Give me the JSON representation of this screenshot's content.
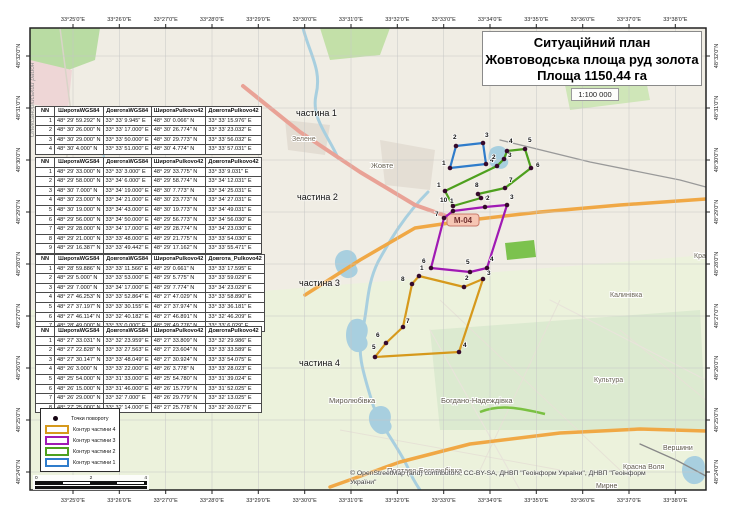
{
  "title_box": {
    "line1": "Ситуаційний план",
    "line2": "Жовтоводська площа руд золота",
    "line3": "Площа 1150,44 га"
  },
  "scale_label": "1:100 000",
  "attribution": {
    "line1": "© OpenStreetMap (and) contributors, CC-BY-SA, ДНВП \"Геоінформ України\", ДНВП \"Геоінформ",
    "line2": "України\""
  },
  "scalebar": {
    "ticks": [
      "0",
      "2",
      "4"
    ]
  },
  "legend": {
    "items": [
      {
        "type": "point",
        "label": "Точки повороту",
        "color": "#160412"
      },
      {
        "type": "outline",
        "label": "Контур частини 4",
        "color": "#d6991c"
      },
      {
        "type": "outline",
        "label": "Контур частини 3",
        "color": "#a01ab4"
      },
      {
        "type": "outline",
        "label": "Контур частини 2",
        "color": "#4ea01e"
      },
      {
        "type": "outline",
        "label": "Контур частини 1",
        "color": "#2f7ccb"
      }
    ]
  },
  "axes": {
    "lon_labels": [
      "33°25'0\"E",
      "33°26'0\"E",
      "33°27'0\"E",
      "33°28'0\"E",
      "33°29'0\"E",
      "33°30'0\"E",
      "33°31'0\"E",
      "33°32'0\"E",
      "33°33'0\"E",
      "33°34'0\"E",
      "33°35'0\"E",
      "33°36'0\"E",
      "33°37'0\"E",
      "33°38'0\"E"
    ],
    "lon_ticks_x": [
      73,
      119.3,
      165.7,
      212,
      258.3,
      304.7,
      351,
      397.3,
      443.7,
      490,
      536.3,
      582.7,
      629,
      675.3
    ],
    "lat_labels": [
      "48°32'0\"N",
      "48°31'0\"N",
      "48°30'0\"N",
      "48°29'0\"N",
      "48°28'0\"N",
      "48°27'0\"N",
      "48°26'0\"N",
      "48°25'0\"N",
      "48°24'0\"N"
    ],
    "lat_ticks_y": [
      56,
      108,
      160,
      212,
      264,
      316,
      368,
      420,
      472
    ]
  },
  "tables": [
    {
      "caption": "частина 1",
      "caption_pos": [
        296,
        108
      ],
      "pos_class": "t1",
      "headers": [
        "NN",
        "ШиротаWGS84",
        "ДовготаWGS84",
        "ШиротаPulkovo42",
        "ДовготаPulkovo42"
      ],
      "rows": [
        [
          "1",
          "48° 29' 59.292\" N",
          "33° 33' 9.945\" E",
          "48° 30' 0.066\" N",
          "33° 33' 15.976\" E"
        ],
        [
          "2",
          "48° 30' 26.000\" N",
          "33° 33' 17.000\" E",
          "48° 30' 26.774\" N",
          "33° 33' 23.032\" E"
        ],
        [
          "3",
          "48° 30' 29.000\" N",
          "33° 33' 50.000\" E",
          "48° 30' 29.773\" N",
          "33° 33' 56.032\" E"
        ],
        [
          "4",
          "48° 30' 4.000\" N",
          "33° 33' 51.000\" E",
          "48° 30' 4.774\" N",
          "33° 33' 57.031\" E"
        ]
      ]
    },
    {
      "caption": "частина 2",
      "caption_pos": [
        297,
        192
      ],
      "pos_class": "t2",
      "headers": [
        "NN",
        "ШиротаWGS84",
        "ДовготаWGS84",
        "ШиротаPulkovo42",
        "ДовготаPulkovo42"
      ],
      "rows": [
        [
          "1",
          "48° 29' 33.000\" N",
          "33° 33' 3.000\" E",
          "48° 29' 33.775\" N",
          "33° 33' 9.031\" E"
        ],
        [
          "2",
          "48° 29' 58.000\" N",
          "33° 34' 6.000\" E",
          "48° 29' 58.774\" N",
          "33° 34' 12.031\" E"
        ],
        [
          "3",
          "48° 30' 7.000\" N",
          "33° 34' 19.000\" E",
          "48° 30' 7.773\" N",
          "33° 34' 25.031\" E"
        ],
        [
          "4",
          "48° 30' 23.000\" N",
          "33° 34' 21.000\" E",
          "48° 30' 23.773\" N",
          "33° 34' 27.031\" E"
        ],
        [
          "5",
          "48° 30' 19.000\" N",
          "33° 34' 43.000\" E",
          "48° 30' 19.773\" N",
          "33° 34' 49.031\" E"
        ],
        [
          "6",
          "48° 29' 56.000\" N",
          "33° 34' 50.000\" E",
          "48° 29' 56.773\" N",
          "33° 34' 56.030\" E"
        ],
        [
          "7",
          "48° 29' 28.000\" N",
          "33° 34' 17.000\" E",
          "48° 29' 28.774\" N",
          "33° 34' 23.030\" E"
        ],
        [
          "8",
          "48° 29' 21.000\" N",
          "33° 33' 48.000\" E",
          "48° 29' 21.775\" N",
          "33° 33' 54.030\" E"
        ],
        [
          "9",
          "48° 29' 16.387\" N",
          "33° 33' 49.442\" E",
          "48° 29' 17.162\" N",
          "33° 33' 55.471\" E"
        ],
        [
          "10",
          "48° 29' 13.401\" N",
          "33° 33' 12.800\" E",
          "48° 29' 14.176\" N",
          "33° 33' 18.830\" E"
        ]
      ]
    },
    {
      "caption": "частина 3",
      "caption_pos": [
        299,
        278
      ],
      "pos_class": "t3",
      "headers": [
        "NN",
        "ШиротаWGS84",
        "ДовготаWGS84",
        "ШиротаPulkovo42",
        "Довгота_Pulkovo42"
      ],
      "rows": [
        [
          "1",
          "48° 28' 59.886\" N",
          "33° 33' 11.566\" E",
          "48° 29' 0.661\" N",
          "33° 33' 17.595\" E"
        ],
        [
          "2",
          "48° 29' 5.000\" N",
          "33° 33' 53.000\" E",
          "48° 29' 5.775\" N",
          "33° 33' 59.029\" E"
        ],
        [
          "3",
          "48° 29' 7.000\" N",
          "33° 34' 17.000\" E",
          "48° 29' 7.774\" N",
          "33° 34' 23.029\" E"
        ],
        [
          "4",
          "48° 27' 46.253\" N",
          "33° 33' 52.864\" E",
          "48° 27' 47.029\" N",
          "33° 33' 58.890\" E"
        ],
        [
          "5",
          "48° 27' 37.197\" N",
          "33° 33' 30.155\" E",
          "48° 27' 37.974\" N",
          "33° 33' 36.181\" E"
        ],
        [
          "6",
          "48° 27' 46.114\" N",
          "33° 32' 40.182\" E",
          "48° 27' 46.891\" N",
          "33° 32' 46.209\" E"
        ],
        [
          "7",
          "48° 28' 49.000\" N",
          "33° 33' 0.000\" E",
          "48° 28' 49.776\" N",
          "33° 33' 6.029\" E"
        ]
      ]
    },
    {
      "caption": "частина 4",
      "caption_pos": [
        299,
        358
      ],
      "pos_class": "t4",
      "headers": [
        "NN",
        "ШиротаWGS84",
        "ДовготаWGS84",
        "ШиротаPulkovo42",
        "ДовготаPulkovo42"
      ],
      "rows": [
        [
          "1",
          "48° 27' 33.031\" N",
          "33° 32' 23.959\" E",
          "48° 27' 33.809\" N",
          "33° 32' 29.986\" E"
        ],
        [
          "2",
          "48° 27' 22.828\" N",
          "33° 33' 27.563\" E",
          "48° 27' 23.604\" N",
          "33° 33' 33.589\" E"
        ],
        [
          "3",
          "48° 27' 30.147\" N",
          "33° 33' 48.049\" E",
          "48° 27' 30.924\" N",
          "33° 33' 54.075\" E"
        ],
        [
          "4",
          "48° 26' 3.000\" N",
          "33° 33' 22.000\" E",
          "48° 26' 3.778\" N",
          "33° 33' 28.023\" E"
        ],
        [
          "5",
          "48° 25' 54.000\" N",
          "33° 31' 33.000\" E",
          "48° 25' 54.780\" N",
          "33° 31' 39.024\" E"
        ],
        [
          "6",
          "48° 26' 15.000\" N",
          "33° 31' 46.000\" E",
          "48° 26' 15.779\" N",
          "33° 31' 52.025\" E"
        ],
        [
          "7",
          "48° 26' 29.000\" N",
          "33° 32' 7.000\" E",
          "48° 26' 29.779\" N",
          "33° 32' 13.025\" E"
        ],
        [
          "8",
          "48° 27' 25.000\" N",
          "33° 32' 14.000\" E",
          "48° 27' 25.778\" N",
          "33° 32' 20.027\" E"
        ]
      ]
    }
  ],
  "map": {
    "frame": [
      30,
      28,
      676,
      462
    ],
    "bg": "#f0ede4",
    "grid_color": "#c6c6c6",
    "dot_color": "#36092c",
    "areas": [
      {
        "fill": "#b9dca3",
        "d": "M30,28 L100,28 L95,60 L55,75 L30,66 Z"
      },
      {
        "fill": "#c3e0a8",
        "d": "M320,28 L390,28 L380,55 L330,60 Z"
      },
      {
        "fill": "#eed6d6",
        "d": "M30,60 L72,70 L68,110 L30,104 Z"
      },
      {
        "fill": "#e3ddd3",
        "d": "M285,120 L330,125 L325,155 L288,150 Z"
      },
      {
        "fill": "#e4ded4",
        "d": "M380,140 L435,150 L430,190 L385,185 Z"
      },
      {
        "fill": "#ecf2dc",
        "d": "M30,310 L706,255 L706,490 L30,490 Z"
      },
      {
        "fill": "#dcead0",
        "d": "M430,330 L700,310 L706,430 L440,430 Z"
      },
      {
        "fill": "#cfe6b8",
        "d": "M560,60 L640,50 L650,100 L570,110 Z"
      },
      {
        "fill": "#7cc24e",
        "d": "M505,243 L534,240 L536,257 L507,260 Z"
      }
    ],
    "field_lines": [
      "M440,300 L620,470",
      "M560,300 L480,470",
      "M340,430 L560,470",
      "M620,330 L706,400"
    ],
    "water_strokes": [
      {
        "w": 3,
        "d": "M303,28 C310,55 322,70 316,95 C311,118 328,135 338,158"
      },
      {
        "w": 3,
        "d": "M428,192 C405,215 390,240 378,262 C366,286 368,310 362,332 C356,356 366,380 372,402 C380,426 398,446 408,468 C412,478 416,484 420,490"
      },
      {
        "w": 2,
        "d": "M100,140 C108,165 104,190 112,215 C118,235 112,255 118,275"
      }
    ],
    "water_fills": [
      "M492,148 C500,143 510,148 506,158 C512,162 505,172 497,168 C488,170 486,152 492,148 Z",
      "M352,320 C362,315 372,325 366,338 C372,348 360,356 352,350 C344,344 344,326 352,320 Z",
      "M340,252 C350,246 360,254 356,266 C362,274 350,282 342,276 C334,270 332,258 340,252 Z",
      "M374,408 C384,402 394,410 390,422 C396,430 384,438 376,432 C368,426 366,414 374,408 Z",
      "M688,458 C698,452 708,460 704,472 C708,480 696,488 688,482 C680,476 680,464 688,458 Z"
    ],
    "green_stroke": "M480,412 C500,404 520,408 545,414",
    "roads": [
      {
        "color": "#d9d4c8",
        "w": 1.5,
        "d": "M60,28 L72,120 L58,220 L66,320"
      },
      {
        "color": "#e8e4da",
        "w": 1.2,
        "d": "M430,330 L520,490"
      },
      {
        "color": "#e8e4da",
        "w": 1.2,
        "d": "M550,300 L706,380"
      },
      {
        "color": "#999999",
        "w": 1.3,
        "d": "M500,140 L590,162 L680,180 L706,187"
      },
      {
        "color": "#888888",
        "w": 1.3,
        "d": "M640,444 L676,460 L706,476"
      },
      {
        "color": "#e9a296",
        "w": 4,
        "d": "M243,86 L300,132 L360,172 L415,205 L452,218"
      },
      {
        "color": "#f0a845",
        "w": 3.5,
        "d": "M305,295 L360,260 L415,228 L470,220 L540,212 L620,205 L706,199"
      },
      {
        "color": "#f0a845",
        "w": 3.5,
        "d": "M330,487 L400,462 L470,444 L560,433 L640,429 L706,431"
      }
    ],
    "shield": {
      "x": 447,
      "y": 214,
      "w": 32,
      "h": 12,
      "label": "М-04",
      "bg": "#f6c6b4",
      "border": "#c97b6b",
      "text_color": "#703030"
    },
    "district_label": {
      "text": "Олександрійський район",
      "x": 34,
      "y": 100
    },
    "places": [
      {
        "name": "Зелене",
        "x": 292,
        "y": 141,
        "s": 7,
        "c": "#7a7060"
      },
      {
        "name": "Жовте",
        "x": 371,
        "y": 168,
        "s": 7.5,
        "c": "#6b6557"
      },
      {
        "name": "Калинівка",
        "x": 610,
        "y": 297,
        "s": 7,
        "c": "#6b6557"
      },
      {
        "name": "Культура",
        "x": 594,
        "y": 382,
        "s": 7,
        "c": "#6b6557"
      },
      {
        "name": "Красний",
        "x": 694,
        "y": 258,
        "s": 7,
        "c": "#6b6557"
      },
      {
        "name": "Миролюбівка",
        "x": 329,
        "y": 403,
        "s": 7.5,
        "c": "#5f594c"
      },
      {
        "name": "Богдано-Надеждівка",
        "x": 441,
        "y": 403,
        "s": 7.5,
        "c": "#5f594c"
      },
      {
        "name": "Полтаво-Боголюбівка",
        "x": 387,
        "y": 473,
        "s": 7.5,
        "c": "#5f594c"
      },
      {
        "name": "Красна Воля",
        "x": 623,
        "y": 469,
        "s": 7,
        "c": "#5f594c"
      },
      {
        "name": "Вершини",
        "x": 663,
        "y": 450,
        "s": 7,
        "c": "#5f594c"
      },
      {
        "name": "Мирне",
        "x": 596,
        "y": 488,
        "s": 7,
        "c": "#5f594c"
      }
    ],
    "polygons": [
      {
        "name": "contour-part-1",
        "color": "#2f7ccb",
        "points": [
          [
            450,
            168,
            -8,
            -3
          ],
          [
            456,
            146,
            -3,
            -7
          ],
          [
            483,
            143,
            2,
            -6
          ],
          [
            486,
            164,
            4,
            -2
          ]
        ]
      },
      {
        "name": "contour-part-2",
        "color": "#4ea01e",
        "points": [
          [
            445,
            191,
            -8,
            -4
          ],
          [
            497,
            166,
            -5,
            -7
          ],
          [
            504,
            159,
            4,
            -2
          ],
          [
            507,
            151,
            2,
            -8
          ],
          [
            525,
            149,
            3,
            -7
          ],
          [
            531,
            168,
            5,
            -1
          ],
          [
            505,
            188,
            4,
            -6
          ],
          [
            478,
            194,
            -3,
            -7
          ],
          [
            481,
            198,
            4,
            2
          ],
          [
            453,
            206,
            -13,
            -4
          ]
        ]
      },
      {
        "name": "contour-part-3",
        "color": "#a01ab4",
        "points": [
          [
            453,
            211,
            -3,
            -8
          ],
          [
            485,
            207,
            1,
            -7
          ],
          [
            507,
            205,
            3,
            -6
          ],
          [
            487,
            268,
            3,
            -7
          ],
          [
            470,
            272,
            -4,
            -8
          ],
          [
            431,
            268,
            -9,
            -5
          ],
          [
            444,
            218,
            -9,
            -2
          ]
        ]
      },
      {
        "name": "contour-part-4",
        "color": "#d6991c",
        "points": [
          [
            419,
            276,
            1,
            -6
          ],
          [
            464,
            287,
            1,
            -7
          ],
          [
            483,
            279,
            4,
            -4
          ],
          [
            459,
            352,
            4,
            -5
          ],
          [
            375,
            357,
            -3,
            -8
          ],
          [
            386,
            343,
            -10,
            -6
          ],
          [
            403,
            327,
            3,
            -4
          ],
          [
            412,
            284,
            -11,
            -3
          ]
        ]
      }
    ]
  }
}
